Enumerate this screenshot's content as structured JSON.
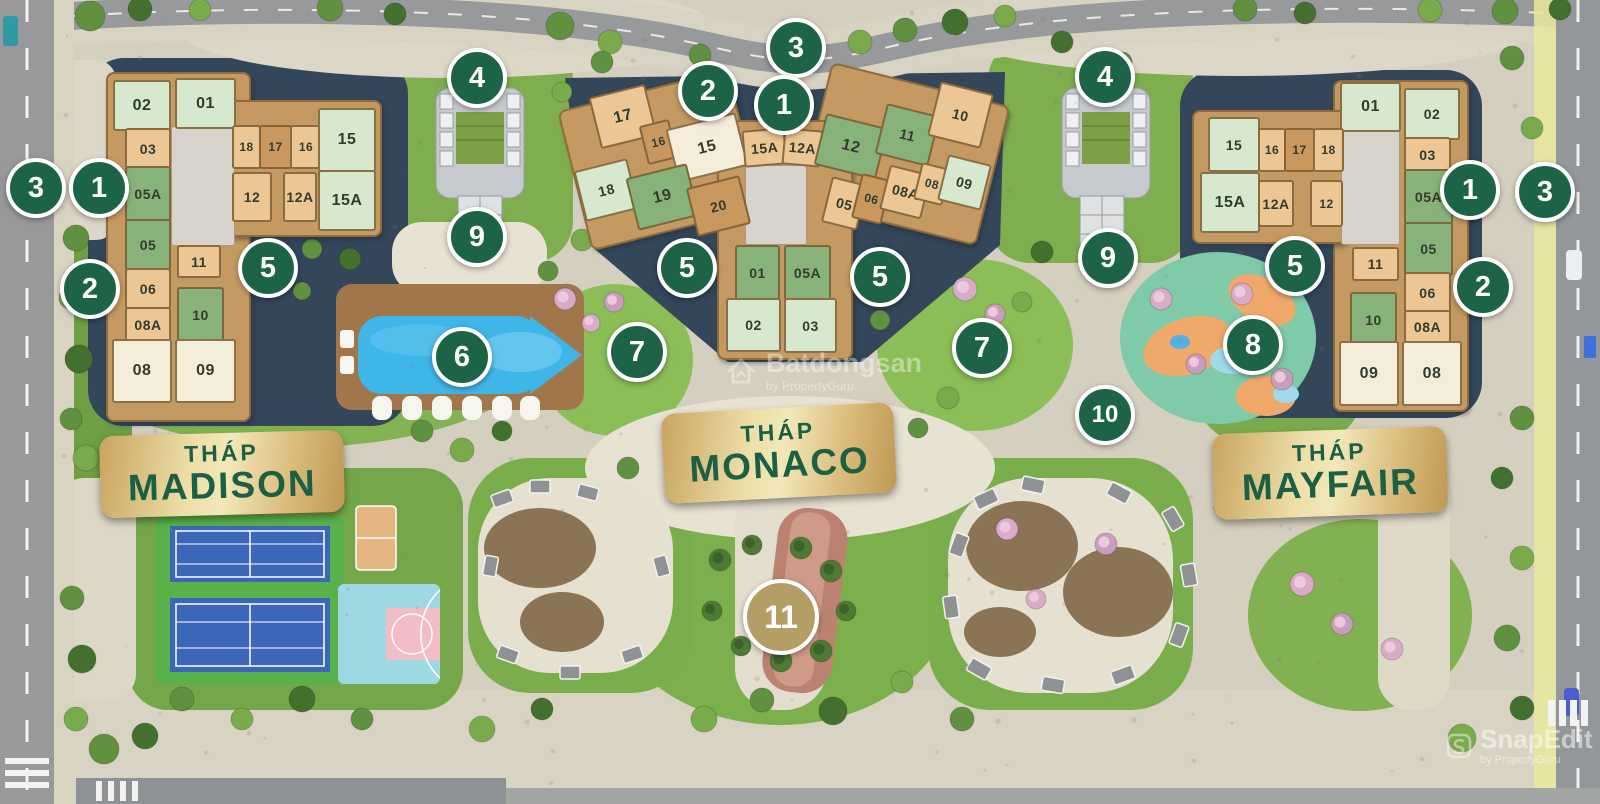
{
  "colors": {
    "marker_green": "#1d6348",
    "marker_gold": "#b49e66",
    "banner_gold": "#e5d094",
    "banner_text_green": "#1b5f45",
    "unit_mint": "#d6e9cf",
    "unit_cream": "#f4edda",
    "unit_green": "#87b37b",
    "unit_tan": "#ecc795",
    "unit_dark_tan": "#c9985f",
    "pool_blue": "#3fb6e8"
  },
  "towers": {
    "madison": {
      "label_top": "THÁP",
      "name": "MADISON",
      "banner": {
        "x": 100,
        "y": 433,
        "w": 244,
        "h": 82,
        "rot": -1.5
      },
      "units": [
        {
          "num": "02",
          "x": 113,
          "y": 80,
          "w": 54,
          "h": 47,
          "c": "mint",
          "r": 0
        },
        {
          "num": "01",
          "x": 175,
          "y": 78,
          "w": 57,
          "h": 47,
          "c": "mint",
          "r": 0
        },
        {
          "num": "03",
          "x": 125,
          "y": 128,
          "w": 42,
          "h": 37,
          "c": "tan",
          "r": 0
        },
        {
          "num": "18",
          "x": 232,
          "y": 125,
          "w": 25,
          "h": 40,
          "c": "tan",
          "r": 0
        },
        {
          "num": "17",
          "x": 259,
          "y": 125,
          "w": 29,
          "h": 40,
          "c": "dtan",
          "r": 0
        },
        {
          "num": "16",
          "x": 290,
          "y": 125,
          "w": 28,
          "h": 40,
          "c": "tan",
          "r": 0
        },
        {
          "num": "15",
          "x": 318,
          "y": 108,
          "w": 54,
          "h": 60,
          "c": "mint",
          "r": 0
        },
        {
          "num": "05A",
          "x": 125,
          "y": 166,
          "w": 42,
          "h": 52,
          "c": "green",
          "r": 0
        },
        {
          "num": "12",
          "x": 232,
          "y": 172,
          "w": 36,
          "h": 46,
          "c": "tan",
          "r": 0
        },
        {
          "num": "12A",
          "x": 283,
          "y": 172,
          "w": 30,
          "h": 46,
          "c": "tan",
          "r": 0
        },
        {
          "num": "15A",
          "x": 318,
          "y": 170,
          "w": 54,
          "h": 57,
          "c": "mint",
          "r": 0
        },
        {
          "num": "05",
          "x": 125,
          "y": 219,
          "w": 42,
          "h": 48,
          "c": "green",
          "r": 0
        },
        {
          "num": "11",
          "x": 177,
          "y": 245,
          "w": 40,
          "h": 29,
          "c": "tan",
          "r": 0
        },
        {
          "num": "06",
          "x": 125,
          "y": 268,
          "w": 42,
          "h": 38,
          "c": "tan",
          "r": 0
        },
        {
          "num": "10",
          "x": 177,
          "y": 287,
          "w": 43,
          "h": 51,
          "c": "green",
          "r": 0
        },
        {
          "num": "08A",
          "x": 125,
          "y": 307,
          "w": 42,
          "h": 31,
          "c": "tan",
          "r": 0
        },
        {
          "num": "08",
          "x": 112,
          "y": 339,
          "w": 56,
          "h": 60,
          "c": "cream",
          "r": 0
        },
        {
          "num": "09",
          "x": 175,
          "y": 339,
          "w": 57,
          "h": 60,
          "c": "cream",
          "r": 0
        }
      ]
    },
    "monaco": {
      "label_top": "THÁP",
      "name": "MONACO",
      "banner": {
        "x": 663,
        "y": 408,
        "w": 232,
        "h": 90,
        "rot": -3
      },
      "units": [
        {
          "num": "17",
          "x": 594,
          "y": 90,
          "w": 54,
          "h": 49,
          "c": "tan",
          "r": -14
        },
        {
          "num": "16",
          "x": 643,
          "y": 122,
          "w": 27,
          "h": 36,
          "c": "dtan",
          "r": -14
        },
        {
          "num": "15",
          "x": 671,
          "y": 120,
          "w": 68,
          "h": 51,
          "c": "cream",
          "r": -14
        },
        {
          "num": "15A",
          "x": 743,
          "y": 129,
          "w": 39,
          "h": 33,
          "c": "tan",
          "r": -5
        },
        {
          "num": "12A",
          "x": 783,
          "y": 129,
          "w": 35,
          "h": 33,
          "c": "tan",
          "r": 5
        },
        {
          "num": "12",
          "x": 819,
          "y": 120,
          "w": 60,
          "h": 49,
          "c": "green",
          "r": 14
        },
        {
          "num": "11",
          "x": 880,
          "y": 109,
          "w": 51,
          "h": 48,
          "c": "green",
          "r": 14
        },
        {
          "num": "10",
          "x": 933,
          "y": 87,
          "w": 51,
          "h": 52,
          "c": "tan",
          "r": 14
        },
        {
          "num": "18",
          "x": 579,
          "y": 164,
          "w": 51,
          "h": 48,
          "c": "mint",
          "r": -14
        },
        {
          "num": "19",
          "x": 631,
          "y": 170,
          "w": 59,
          "h": 50,
          "c": "green",
          "r": -14
        },
        {
          "num": "20",
          "x": 691,
          "y": 181,
          "w": 51,
          "h": 46,
          "c": "dtan",
          "r": -14
        },
        {
          "num": "05",
          "x": 826,
          "y": 180,
          "w": 33,
          "h": 43,
          "c": "tan",
          "r": 14
        },
        {
          "num": "06",
          "x": 856,
          "y": 176,
          "w": 27,
          "h": 42,
          "c": "dtan",
          "r": 14
        },
        {
          "num": "08A",
          "x": 884,
          "y": 169,
          "w": 39,
          "h": 42,
          "c": "tan",
          "r": 14
        },
        {
          "num": "08",
          "x": 917,
          "y": 165,
          "w": 26,
          "h": 34,
          "c": "tan",
          "r": 14
        },
        {
          "num": "09",
          "x": 942,
          "y": 159,
          "w": 41,
          "h": 43,
          "c": "mint",
          "r": 14
        },
        {
          "num": "01",
          "x": 735,
          "y": 245,
          "w": 41,
          "h": 52,
          "c": "green",
          "r": 0
        },
        {
          "num": "05A",
          "x": 784,
          "y": 245,
          "w": 43,
          "h": 52,
          "c": "green",
          "r": 0
        },
        {
          "num": "02",
          "x": 726,
          "y": 298,
          "w": 51,
          "h": 50,
          "c": "mint",
          "r": 0
        },
        {
          "num": "03",
          "x": 784,
          "y": 298,
          "w": 49,
          "h": 51,
          "c": "mint",
          "r": 0
        }
      ]
    },
    "mayfair": {
      "label_top": "THÁP",
      "name": "MAYFAIR",
      "banner": {
        "x": 1213,
        "y": 430,
        "w": 234,
        "h": 86,
        "rot": -2
      },
      "units": [
        {
          "num": "01",
          "x": 1340,
          "y": 82,
          "w": 57,
          "h": 46,
          "c": "mint",
          "r": 0
        },
        {
          "num": "02",
          "x": 1404,
          "y": 88,
          "w": 52,
          "h": 48,
          "c": "mint",
          "r": 0
        },
        {
          "num": "15",
          "x": 1208,
          "y": 117,
          "w": 48,
          "h": 51,
          "c": "mint",
          "r": 0
        },
        {
          "num": "16",
          "x": 1258,
          "y": 128,
          "w": 24,
          "h": 40,
          "c": "tan",
          "r": 0
        },
        {
          "num": "17",
          "x": 1284,
          "y": 128,
          "w": 27,
          "h": 40,
          "c": "dtan",
          "r": 0
        },
        {
          "num": "18",
          "x": 1313,
          "y": 128,
          "w": 27,
          "h": 40,
          "c": "tan",
          "r": 0
        },
        {
          "num": "03",
          "x": 1404,
          "y": 137,
          "w": 43,
          "h": 31,
          "c": "tan",
          "r": 0
        },
        {
          "num": "15A",
          "x": 1200,
          "y": 172,
          "w": 56,
          "h": 57,
          "c": "mint",
          "r": 0
        },
        {
          "num": "12A",
          "x": 1258,
          "y": 180,
          "w": 32,
          "h": 43,
          "c": "tan",
          "r": 0
        },
        {
          "num": "12",
          "x": 1310,
          "y": 180,
          "w": 29,
          "h": 43,
          "c": "tan",
          "r": 0
        },
        {
          "num": "05A",
          "x": 1404,
          "y": 169,
          "w": 45,
          "h": 52,
          "c": "green",
          "r": 0
        },
        {
          "num": "05",
          "x": 1404,
          "y": 222,
          "w": 45,
          "h": 50,
          "c": "green",
          "r": 0
        },
        {
          "num": "11",
          "x": 1352,
          "y": 247,
          "w": 43,
          "h": 30,
          "c": "tan",
          "r": 0
        },
        {
          "num": "06",
          "x": 1404,
          "y": 272,
          "w": 43,
          "h": 38,
          "c": "tan",
          "r": 0
        },
        {
          "num": "10",
          "x": 1350,
          "y": 292,
          "w": 43,
          "h": 51,
          "c": "green",
          "r": 0
        },
        {
          "num": "08A",
          "x": 1404,
          "y": 310,
          "w": 43,
          "h": 29,
          "c": "tan",
          "r": 0
        },
        {
          "num": "09",
          "x": 1339,
          "y": 341,
          "w": 56,
          "h": 61,
          "c": "cream",
          "r": 0
        },
        {
          "num": "08",
          "x": 1402,
          "y": 341,
          "w": 56,
          "h": 61,
          "c": "cream",
          "r": 0
        }
      ]
    }
  },
  "markers": [
    {
      "num": "3",
      "x": 36,
      "y": 188
    },
    {
      "num": "1",
      "x": 99,
      "y": 188
    },
    {
      "num": "2",
      "x": 90,
      "y": 289
    },
    {
      "num": "5",
      "x": 268,
      "y": 268
    },
    {
      "num": "4",
      "x": 477,
      "y": 78
    },
    {
      "num": "9",
      "x": 477,
      "y": 237
    },
    {
      "num": "6",
      "x": 462,
      "y": 357
    },
    {
      "num": "7",
      "x": 637,
      "y": 352
    },
    {
      "num": "2",
      "x": 708,
      "y": 91
    },
    {
      "num": "3",
      "x": 796,
      "y": 48
    },
    {
      "num": "1",
      "x": 784,
      "y": 105
    },
    {
      "num": "5",
      "x": 687,
      "y": 268
    },
    {
      "num": "5",
      "x": 880,
      "y": 277
    },
    {
      "num": "7",
      "x": 982,
      "y": 348
    },
    {
      "num": "9",
      "x": 1108,
      "y": 258
    },
    {
      "num": "4",
      "x": 1105,
      "y": 77
    },
    {
      "num": "10",
      "x": 1105,
      "y": 415
    },
    {
      "num": "8",
      "x": 1253,
      "y": 345
    },
    {
      "num": "5",
      "x": 1295,
      "y": 266
    },
    {
      "num": "1",
      "x": 1470,
      "y": 190
    },
    {
      "num": "2",
      "x": 1483,
      "y": 287
    },
    {
      "num": "3",
      "x": 1545,
      "y": 192
    },
    {
      "num": "11",
      "x": 781,
      "y": 617,
      "variant": "gold"
    }
  ],
  "watermarks": {
    "center": {
      "text": "Batdongsan",
      "subtext": "by PropertyGuru"
    },
    "corner": {
      "text": "SnapEdit",
      "subtext": "by PropertyGuru"
    }
  }
}
